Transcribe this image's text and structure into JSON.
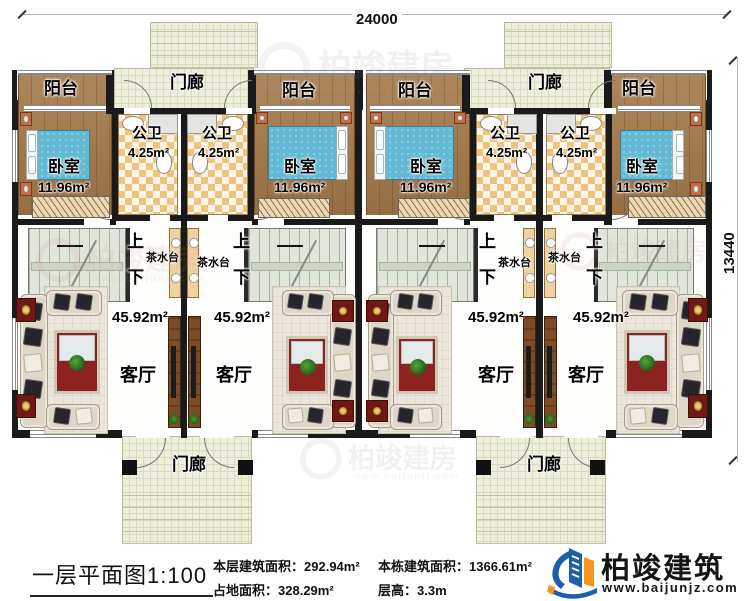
{
  "dimensions": {
    "width_mm": "24000",
    "depth_mm": "13440"
  },
  "plan": {
    "room_labels": {
      "balcony": "阳台",
      "porch": "门廊",
      "bathroom": "公卫",
      "bedroom": "卧室",
      "living_room": "客厅",
      "tea_station": "茶水台",
      "stairs_up": "上",
      "stairs_down": "下"
    },
    "areas": {
      "bathroom": "4.25m²",
      "bedroom": "11.96m²",
      "living_room": "45.92m²"
    }
  },
  "watermark": {
    "brand": "柏竣建房",
    "site": "www.baijunjf.com"
  },
  "footer": {
    "title": "一层平面图1:100",
    "stats": [
      {
        "label": "本层建筑面积：",
        "value": "292.94m²"
      },
      {
        "label": "占地面积：",
        "value": "328.29m²"
      },
      {
        "label": "本栋建筑面积：",
        "value": "1366.61m²"
      },
      {
        "label": "层高：",
        "value": "3.3m"
      }
    ],
    "brand": "柏竣建筑",
    "website": "www.baijunjz.com"
  },
  "colors": {
    "logo_blue": "#1d5fa8",
    "logo_orange": "#f7941d",
    "wall": "#1a1a1a",
    "wood_floor": "#a5794a"
  }
}
